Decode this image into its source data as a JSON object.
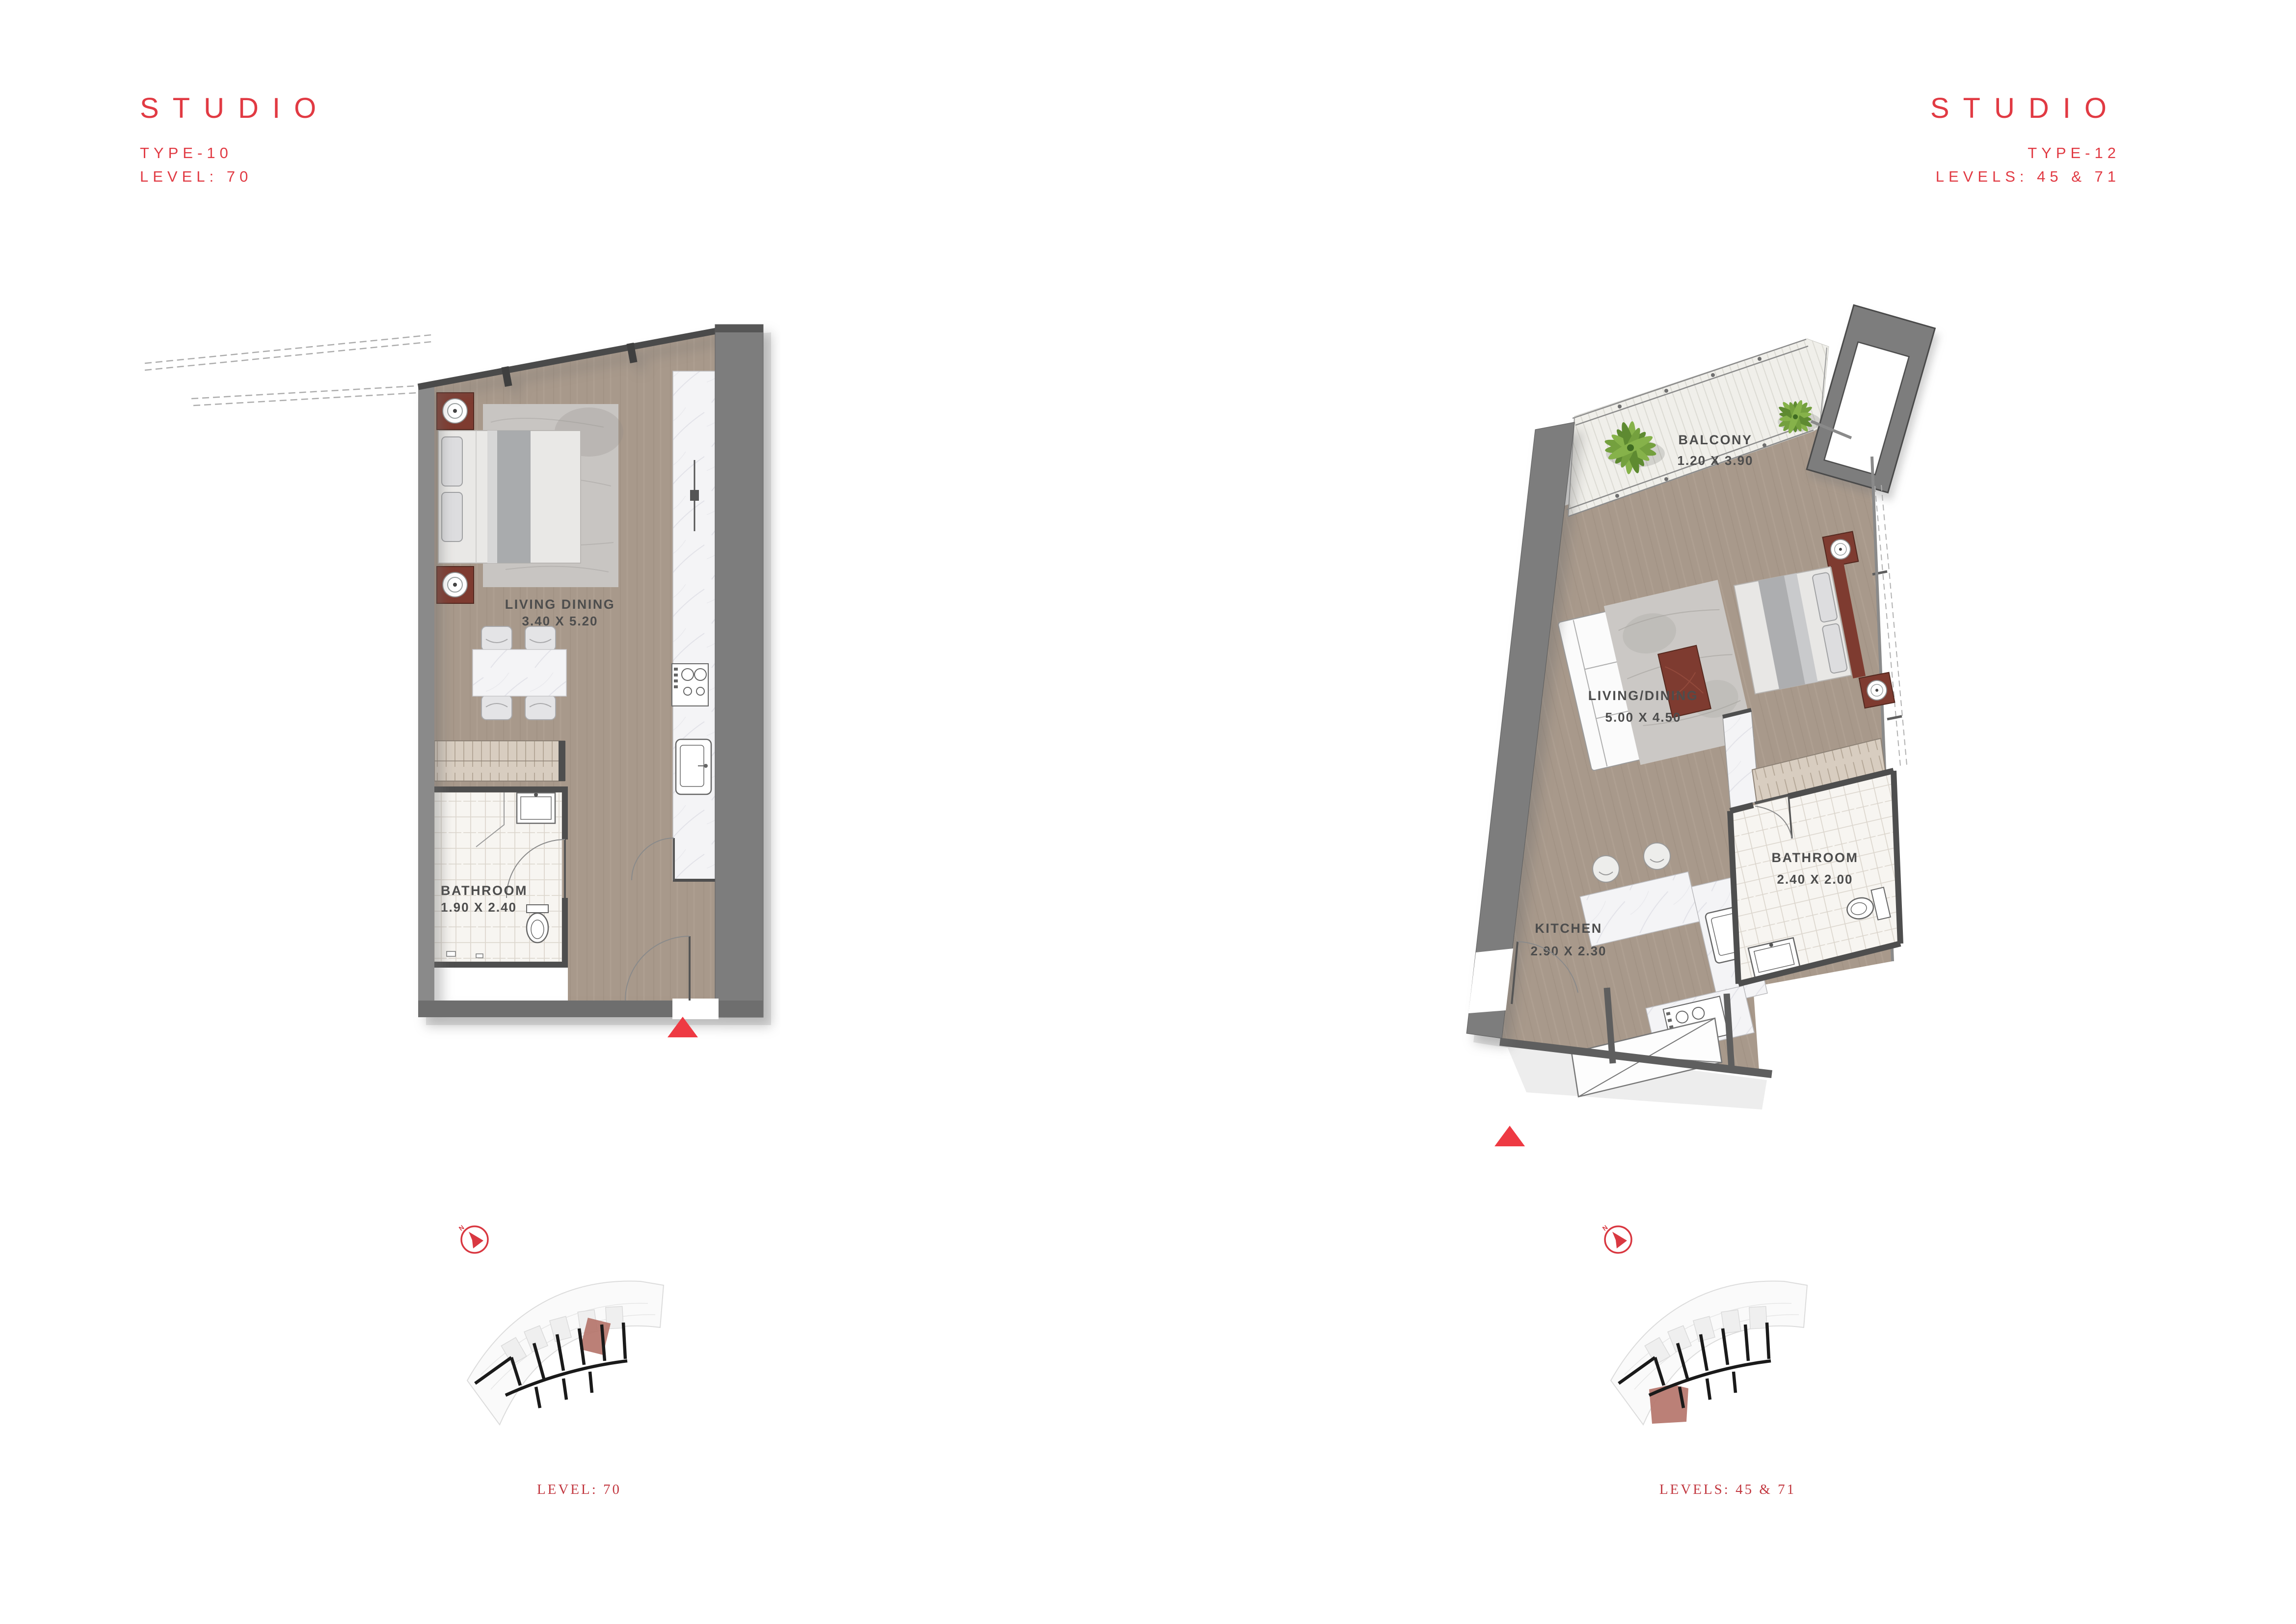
{
  "page": {
    "background": "#FFFFFF"
  },
  "colors": {
    "accent_red": "#E13A43",
    "caption_red": "#C23840",
    "marker_red": "#EE3A43",
    "wall_gray": "#7D7D7D",
    "wall_dark": "#4E4E4E",
    "floor_wood": "#A8998B",
    "marble": "#F4F4F6",
    "tile": "#F7F5F1",
    "furniture_mahogany": "#7E3B30",
    "wardrobe_tan": "#D8CDC0",
    "keyplan_highlight": "#B5756B",
    "plant_green": "#74A03E"
  },
  "left_unit": {
    "title": "STUDIO",
    "type_label": "TYPE-10",
    "level_label": "LEVEL: 70",
    "rooms": {
      "living": {
        "name": "LIVING DINING",
        "dims": "3.40 X 5.20"
      },
      "bathroom": {
        "name": "BATHROOM",
        "dims": "1.90 X 2.40"
      }
    },
    "keyplan_caption": "LEVEL: 70"
  },
  "right_unit": {
    "title": "STUDIO",
    "type_label": "TYPE-12",
    "level_label": "LEVELS: 45 & 71",
    "rooms": {
      "balcony": {
        "name": "BALCONY",
        "dims": "1.20 X 3.90"
      },
      "living": {
        "name": "LIVING/DINING",
        "dims": "5.00 X 4.50"
      },
      "kitchen": {
        "name": "KITCHEN",
        "dims": "2.90 X 2.30"
      },
      "bathroom": {
        "name": "BATHROOM",
        "dims": "2.40 X 2.00"
      }
    },
    "keyplan_caption": "LEVELS: 45 & 71"
  },
  "compass": {
    "north_label": "N"
  }
}
